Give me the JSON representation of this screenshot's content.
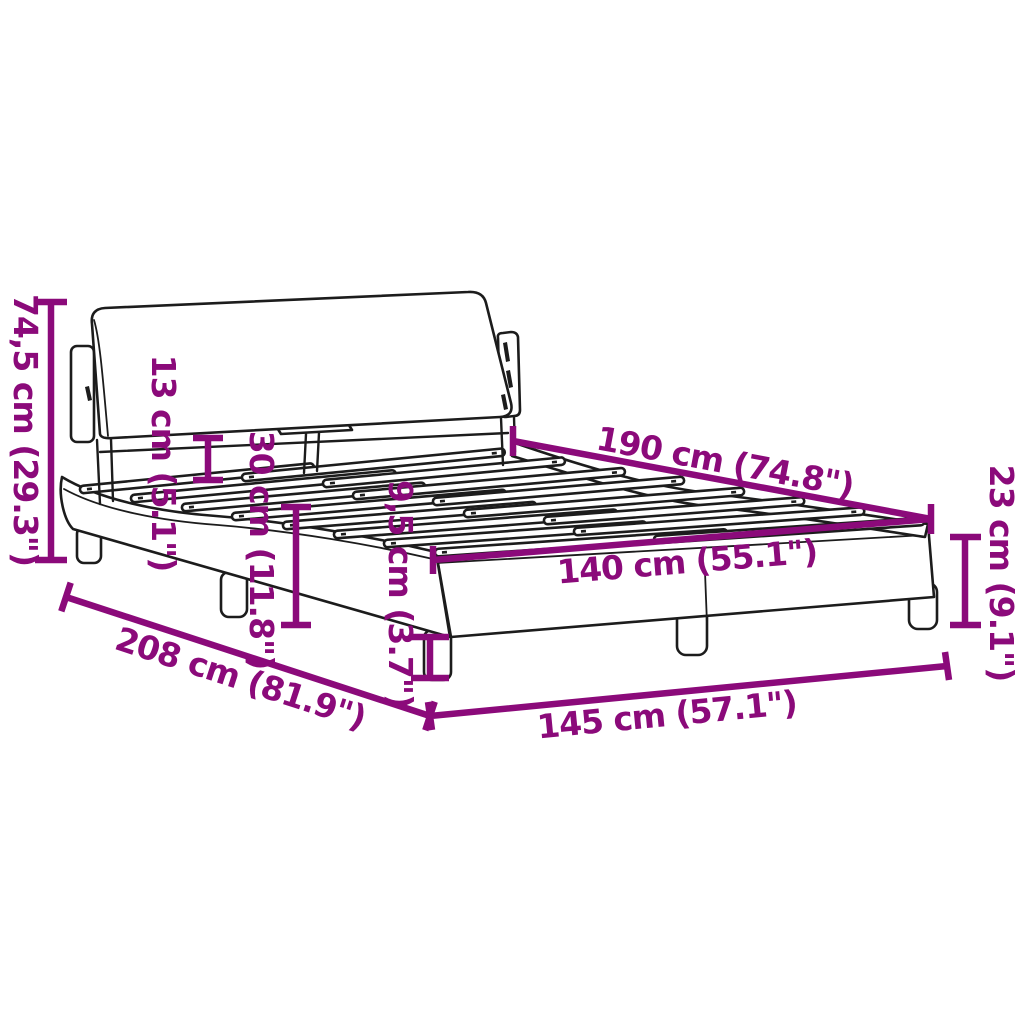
{
  "diagram": {
    "subject": "bed frame with headboard and slatted base – dimension drawing",
    "accent_color": "#8B0A7A",
    "line_color": "#1c1c1c",
    "background_color": "#ffffff",
    "units": "cm / inches",
    "dimensions": {
      "total_height": "74,5 cm (29.3\")",
      "headboard_panel_height": "13 cm (5.1\")",
      "side_height": "30 cm (11.8\")",
      "frame_rail_height": "9,5 cm (3.7\")",
      "slat_base_length": "190 cm (74.8\")",
      "slat_base_width": "140 cm (55.1\")",
      "foot_end_height": "23 cm (9.1\")",
      "total_length": "208 cm (81.9\")",
      "total_width": "145 cm (57.1\")"
    }
  }
}
